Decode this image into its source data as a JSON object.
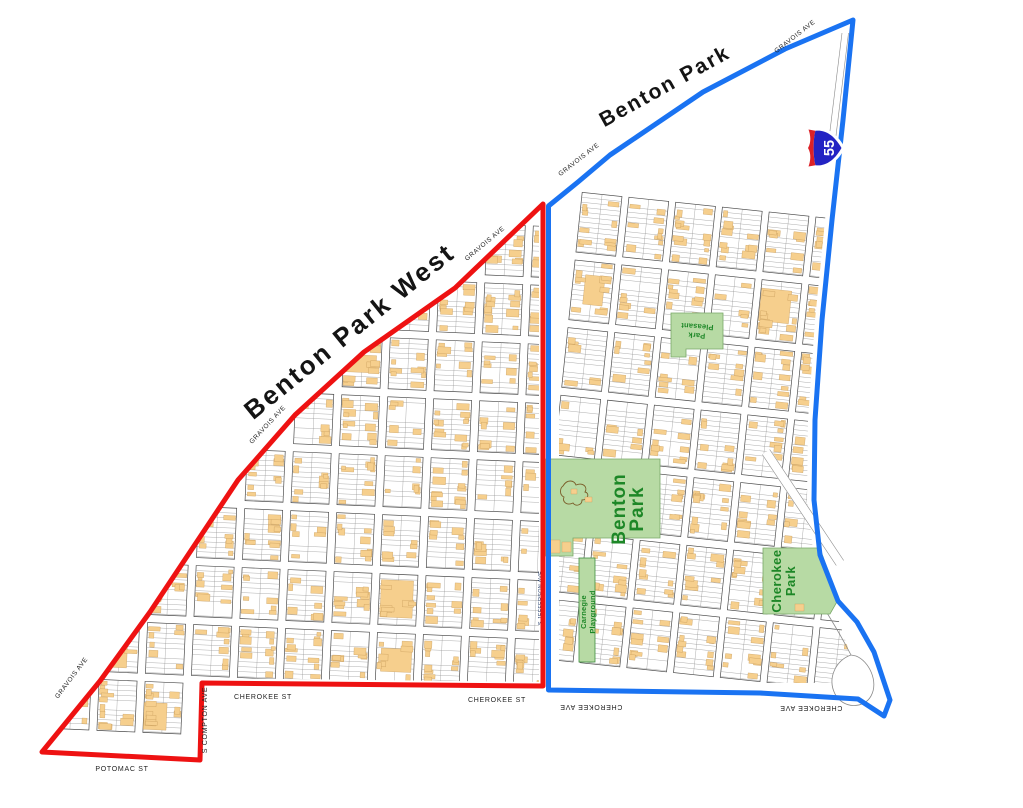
{
  "neighborhoods": {
    "benton_park_west": "Benton Park West",
    "benton_park": "Benton Park"
  },
  "streets": {
    "gravois_ave": "GRAVOIS AVE",
    "cherokee_st": "CHEROKEE ST",
    "cherokee_ave": "CHEROKEE AVE",
    "potomac_st": "POTOMAC ST",
    "s_compton_ave": "S COMPTON AVE",
    "s_jefferson_ave": "S JEFFERSON AVE"
  },
  "parks": {
    "benton_park": {
      "line1": "Benton",
      "line2": "Park"
    },
    "cherokee_park": {
      "line1": "Cherokee",
      "line2": "Park"
    },
    "pleasant_park": {
      "line1": "Pleasant",
      "line2": "Park"
    },
    "carnegie_playground": {
      "line1": "Carnegie",
      "line2": "Playground"
    }
  },
  "highway": {
    "interstate_55": "55"
  },
  "colors": {
    "bpw_boundary": "#ee1212",
    "bp_boundary": "#1a73f2",
    "building": "#f6cf8d",
    "building_edge": "#bf9250",
    "park_fill": "#b7daa4",
    "park_edge": "#79a868",
    "park_text": "#1d8727",
    "street_text": "#1f1f1f",
    "neighborhood_text": "#141414",
    "parcel_line": "#909090",
    "block_line": "#4d4d4d",
    "road_line": "#8a8a8a",
    "shield_blue": "#2323c3",
    "shield_red": "#dc2127",
    "pond_line": "#7a5c28"
  },
  "generator": {
    "seed_a": 11,
    "seed_b": 29
  }
}
